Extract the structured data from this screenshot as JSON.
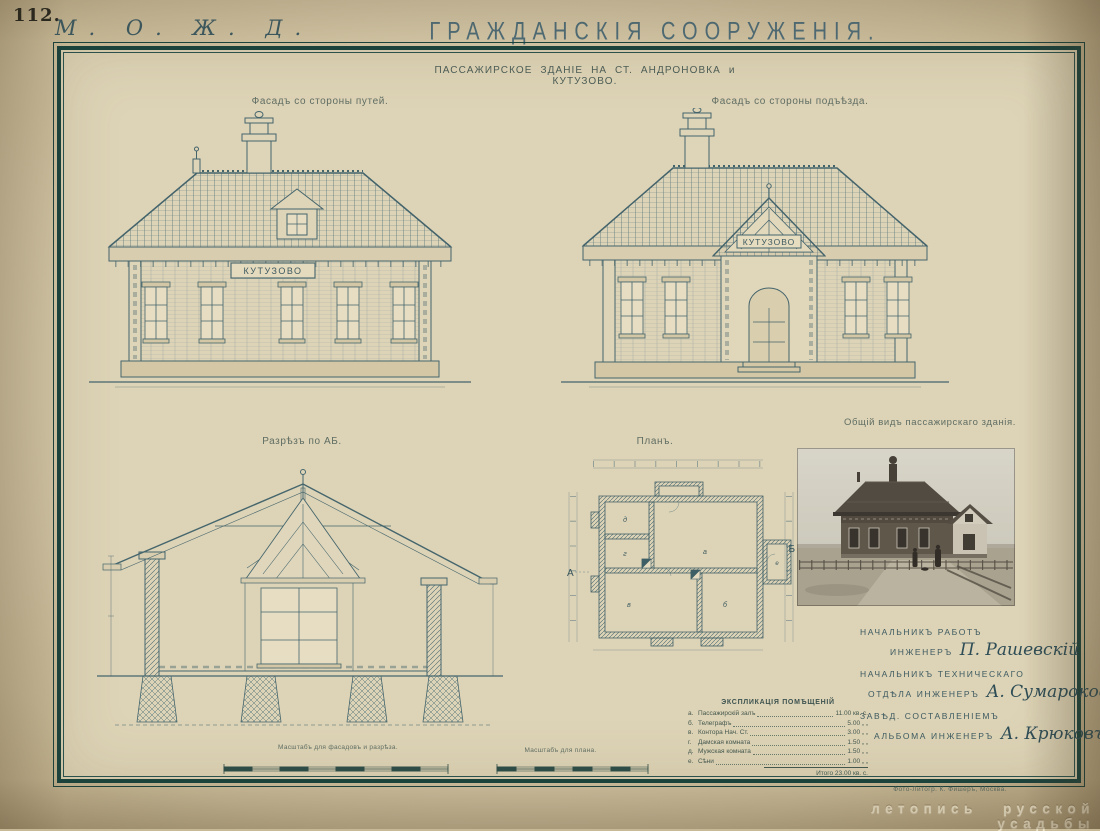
{
  "page": {
    "number": "112.",
    "railway_monogram": "М. О. Ж. Д.",
    "title": "ГРАЖДАНСКІЯ СООРУЖЕНІЯ.",
    "subtitle": "ПАССАЖИРСКОЕ ЗДАНІЕ НА СТ. АНДРОНОВКА  и  КУТУЗОВО.",
    "imprint": "Фото-Литогр. К. Фишеръ, Москва.",
    "watermark": "летопись русской усадьбы"
  },
  "captions": {
    "elevation_track": "Фасадъ со стороны путей.",
    "elevation_entry": "Фасадъ со стороны подъѣзда.",
    "section": "Разрѣзъ по АБ.",
    "plan": "Планъ.",
    "photo": "Общій видъ пассажирскаго зданія.",
    "scale_facades": "Масштабъ для фасадовъ и разрѣза.",
    "scale_plan": "Масштабъ для плана."
  },
  "building": {
    "sign_track": "КУТУЗОВО",
    "sign_entry": "КУТУЗОВО"
  },
  "plan": {
    "marker_a": "А",
    "marker_b": "Б",
    "rooms": [
      "а",
      "б",
      "в",
      "г",
      "д",
      "е"
    ]
  },
  "explication": {
    "title": "ЭКСПЛИКАЦІЯ ПОМѢЩЕНІЙ",
    "rows": [
      {
        "letter": "а.",
        "name": "Пассажирскій залъ",
        "value": "11.00 кв. с."
      },
      {
        "letter": "б.",
        "name": "Телеграфъ",
        "value": "5.00 „ „"
      },
      {
        "letter": "в.",
        "name": "Контора Нач. Ст.",
        "value": "3.00 „ „"
      },
      {
        "letter": "г.",
        "name": "Дамская комната",
        "value": "1.50 „ „"
      },
      {
        "letter": "д.",
        "name": "Мужская комната",
        "value": "1.50 „ „"
      },
      {
        "letter": "е.",
        "name": "Сѣни",
        "value": "1.00 „ „"
      }
    ],
    "total": "Итого 23.00 кв. с."
  },
  "signatures": [
    {
      "line1": "НАЧАЛЬНИКЪ РАБОТЪ",
      "line2": "ИНЖЕНЕРЪ",
      "name": "П. Рашевскій"
    },
    {
      "line1": "НАЧАЛЬНИКЪ ТЕХНИЧЕСКАГО",
      "line2": "ОТДѢЛА ИНЖЕНЕРЪ",
      "name": "А. Сумароковъ"
    },
    {
      "line1": "ЗАВѢД. СОСТАВЛЕНІЕМЪ",
      "line2": "АЛЬБОМА ИНЖЕНЕРЪ",
      "name": "А. Крюковъ"
    }
  ]
}
